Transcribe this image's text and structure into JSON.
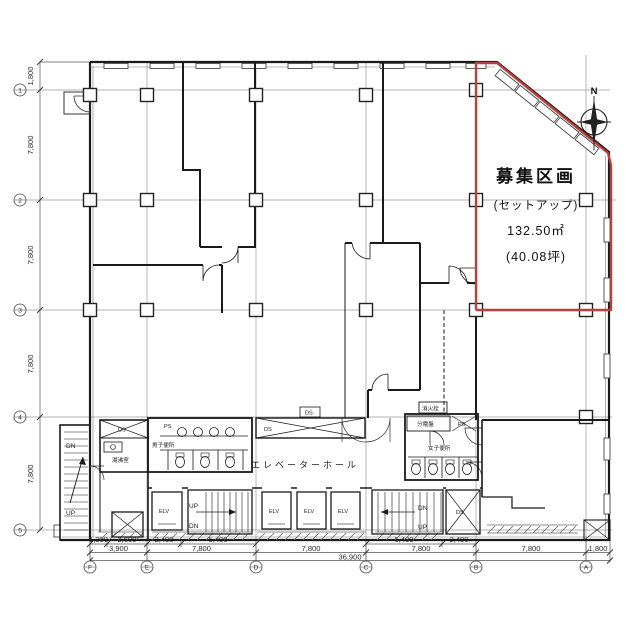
{
  "unit": {
    "title": "募集区画",
    "subtitle": "(セットアップ)",
    "area_m2": "132.50㎡",
    "area_tsubo": "(40.08坪)"
  },
  "compass": {
    "north": "N"
  },
  "grid": {
    "cols": [
      "F",
      "E",
      "D",
      "C",
      "B",
      "A"
    ],
    "rows": [
      "1",
      "2",
      "3",
      "4",
      "5"
    ]
  },
  "dims": {
    "left": [
      "1,800",
      "7,800",
      "7,800",
      "7,800",
      "7,800"
    ],
    "bottom_sub": [
      "1,300",
      "2,600",
      "2,400",
      "5,400",
      "5,400",
      "2,400"
    ],
    "bottom_main": [
      "3,900",
      "7,800",
      "7,800",
      "7,800",
      "7,800",
      "1,800"
    ],
    "bottom_total": "36,900"
  },
  "rooms": {
    "elevator_hall": "エレベーターホール",
    "mens_wc": "男子便所",
    "womens_wc": "女子便所",
    "kitchenette": "湯沸室",
    "elec_panel": "分電盤",
    "fire_hydrant": "消火栓"
  },
  "labels": {
    "elv": "ELV",
    "up": "UP",
    "dn": "DN",
    "ds": "DS",
    "ps": "PS"
  },
  "colors": {
    "unit_outline": "#b8423b",
    "wall": "#1a1a1a",
    "grid": "#9a9a9a"
  }
}
